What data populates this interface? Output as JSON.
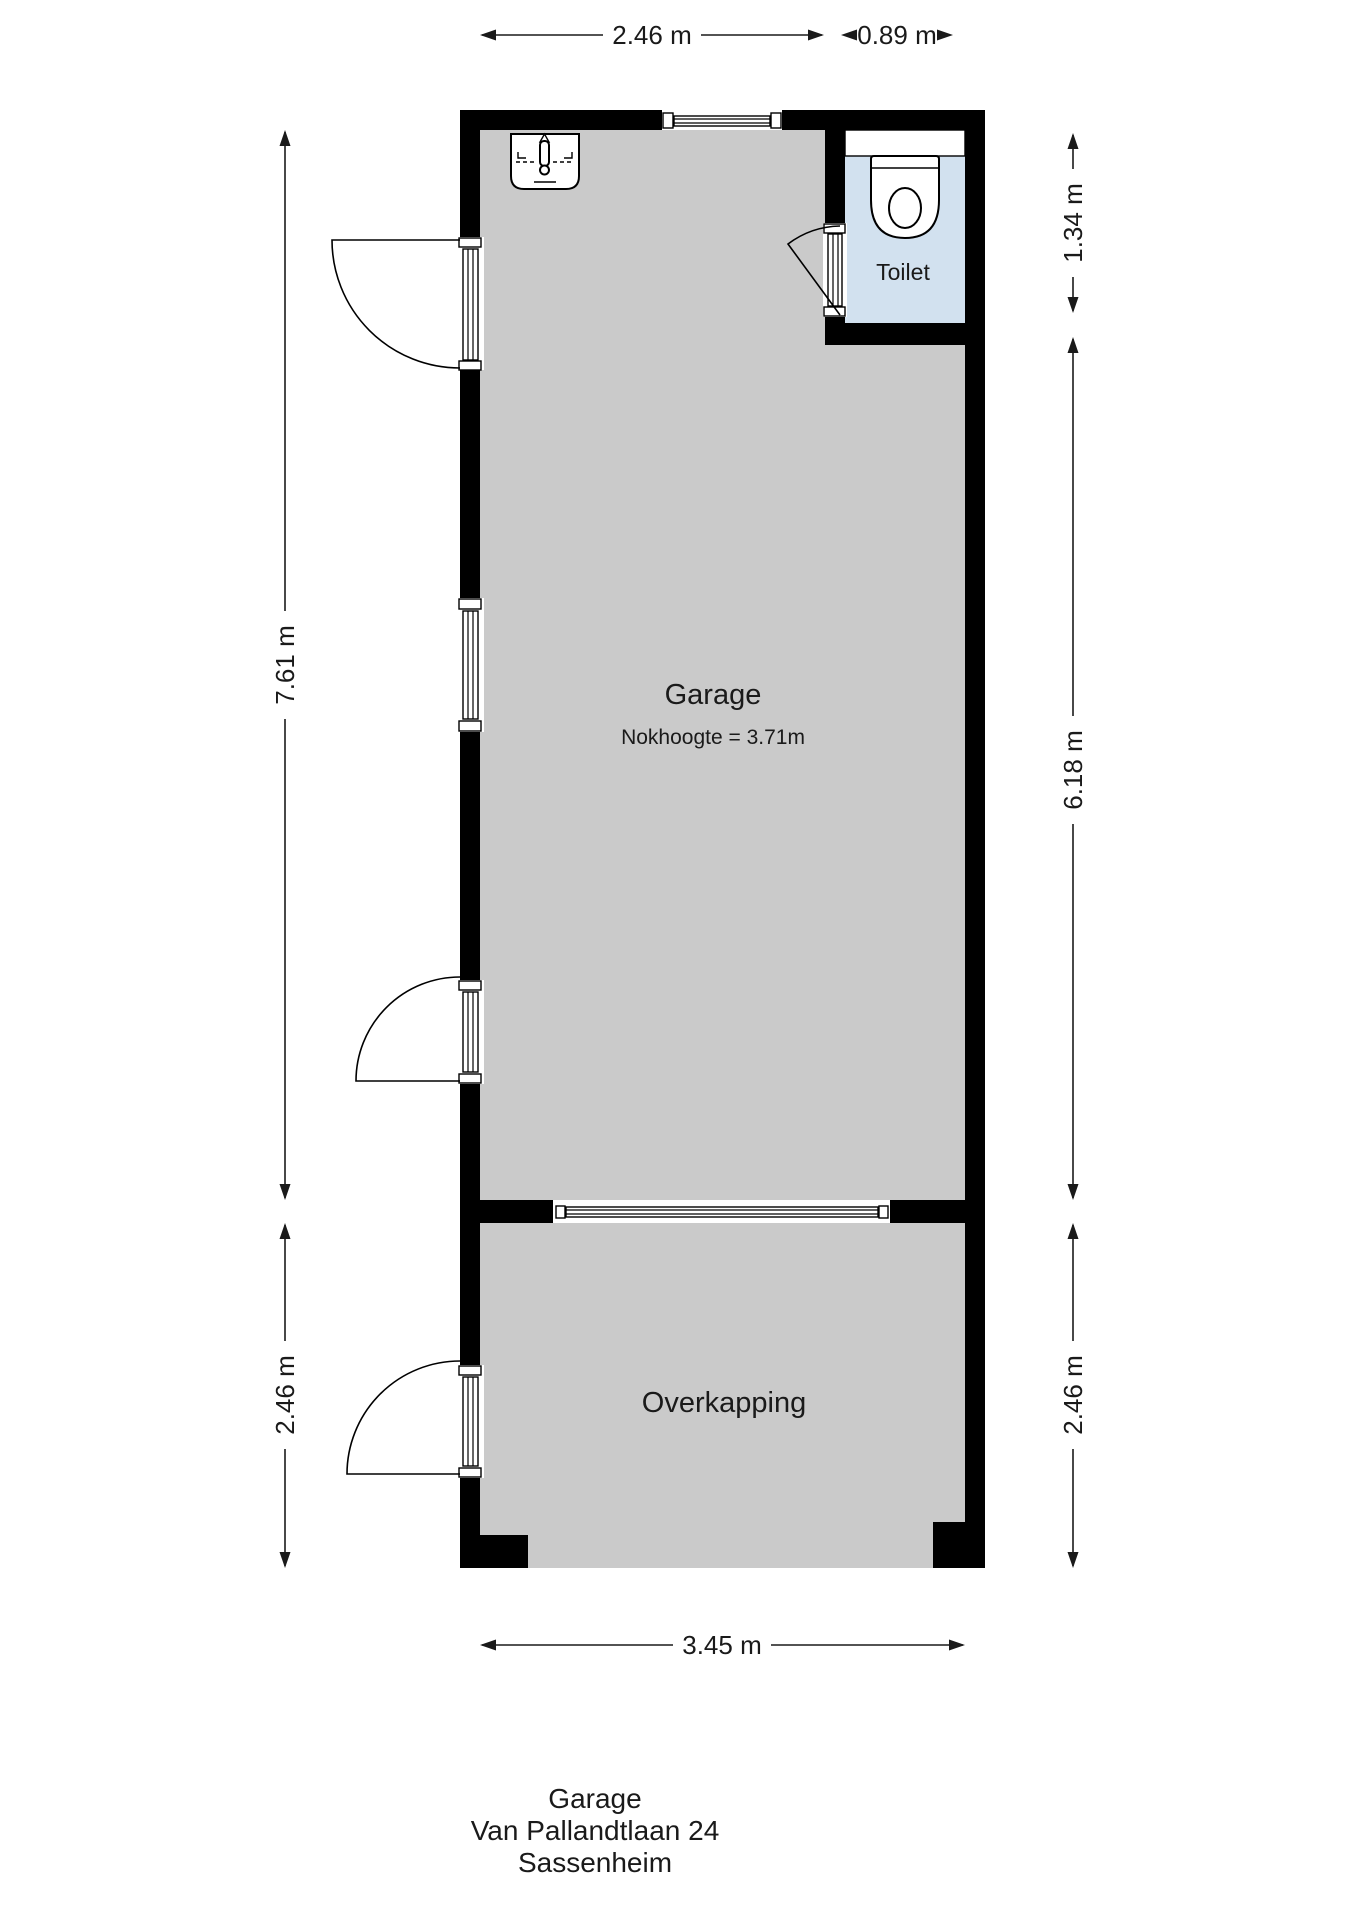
{
  "rooms": {
    "garage": {
      "label": "Garage",
      "note": "Nokhoogte = 3.71m"
    },
    "toilet": {
      "label": "Toilet"
    },
    "overkapping": {
      "label": "Overkapping"
    }
  },
  "dimensions": {
    "top_garage_width": "2.46 m",
    "top_toilet_width": "0.89 m",
    "left_garage_height": "7.61 m",
    "left_overkapping_height": "2.46 m",
    "right_toilet_height": "1.34 m",
    "right_garage_height": "6.18 m",
    "right_overkapping_height": "2.46 m",
    "bottom_width": "3.45 m"
  },
  "footer": {
    "line1": "Garage",
    "line2": "Van Pallandtlaan 24",
    "line3": "Sassenheim"
  },
  "colors": {
    "wall": "#000000",
    "floor": "#cacaca",
    "toilet_floor": "#d2e1ef",
    "text": "#1a1a1a",
    "background": "#ffffff"
  }
}
